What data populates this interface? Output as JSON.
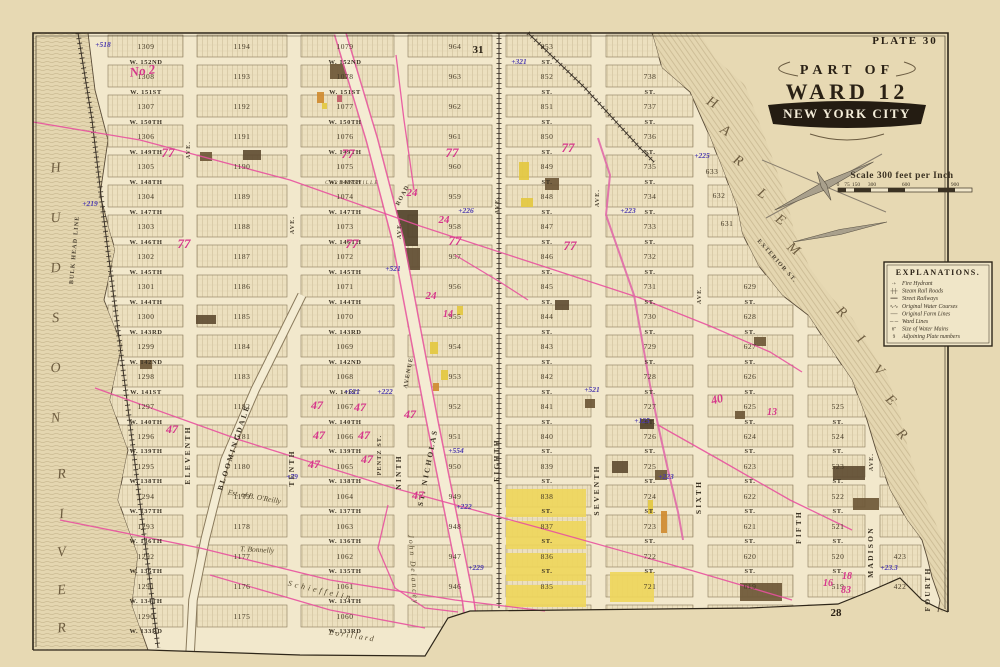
{
  "plate": {
    "label": "PLATE 30",
    "page_top": "31",
    "page_bottom": "28"
  },
  "title": {
    "line1": "PART OF",
    "line2": "WARD 12",
    "line3": "NEW YORK CITY"
  },
  "scale": {
    "caption": "Scale 300 feet per Inch",
    "ticks": [
      "0",
      "75",
      "150",
      "300",
      "600",
      "900"
    ]
  },
  "legend": {
    "title": "EXPLANATIONS.",
    "items": [
      {
        "sym": "·+",
        "label": "Fire Hydrant"
      },
      {
        "sym": "┼┼",
        "label": "Steam Rail Roads"
      },
      {
        "sym": "══",
        "label": "Street Railways"
      },
      {
        "sym": "∿∿",
        "label": "Original Water Courses"
      },
      {
        "sym": "──",
        "label": "Original Farm Lines"
      },
      {
        "sym": "─ ─",
        "label": "Ward Lines"
      },
      {
        "sym": "6″",
        "label": "Size of Water Mains"
      },
      {
        "sym": "9",
        "label": "Adjoining Plate numbers"
      }
    ]
  },
  "map": {
    "street_suffix": "ST.",
    "streets": [
      {
        "name": "W. 152ND",
        "y": 62
      },
      {
        "name": "W. 151ST",
        "y": 92
      },
      {
        "name": "W. 150TH",
        "y": 122
      },
      {
        "name": "W. 149TH",
        "y": 152
      },
      {
        "name": "W. 148TH",
        "y": 182
      },
      {
        "name": "W. 147TH",
        "y": 212
      },
      {
        "name": "W. 146TH",
        "y": 242
      },
      {
        "name": "W. 145TH",
        "y": 272
      },
      {
        "name": "W. 144TH",
        "y": 302
      },
      {
        "name": "W. 143RD",
        "y": 332
      },
      {
        "name": "W. 142ND",
        "y": 362
      },
      {
        "name": "W. 141ST",
        "y": 392
      },
      {
        "name": "W. 140TH",
        "y": 422
      },
      {
        "name": "W. 139TH",
        "y": 451
      },
      {
        "name": "W. 138TH",
        "y": 481
      },
      {
        "name": "W. 137TH",
        "y": 511
      },
      {
        "name": "W. 136TH",
        "y": 541
      },
      {
        "name": "W. 135TH",
        "y": 571
      },
      {
        "name": "W. 134TH",
        "y": 601
      },
      {
        "name": "W. 133RD",
        "y": 631
      }
    ],
    "avenues": [
      {
        "t": "ELEVENTH",
        "x": 190,
        "y": 455,
        "r": -90,
        "c": "ave"
      },
      {
        "t": "TENTH",
        "x": 294,
        "y": 468,
        "r": -90,
        "c": "ave"
      },
      {
        "t": "NINTH",
        "x": 401,
        "y": 472,
        "r": -90,
        "c": "ave"
      },
      {
        "t": "EIGHTH",
        "x": 499,
        "y": 460,
        "r": -90,
        "c": "ave"
      },
      {
        "t": "SEVENTH",
        "x": 599,
        "y": 490,
        "r": -90,
        "c": "ave"
      },
      {
        "t": "SIXTH",
        "x": 701,
        "y": 497,
        "r": -90,
        "c": "ave"
      },
      {
        "t": "FIFTH",
        "x": 801,
        "y": 527,
        "r": -90,
        "c": "ave"
      },
      {
        "t": "MADISON",
        "x": 873,
        "y": 552,
        "r": -90,
        "c": "ave"
      },
      {
        "t": "FOURTH",
        "x": 930,
        "y": 589,
        "r": -90,
        "c": "ave"
      },
      {
        "t": "AVE.",
        "x": 190,
        "y": 150,
        "r": -90,
        "c": "avs"
      },
      {
        "t": "AVE.",
        "x": 294,
        "y": 225,
        "r": -90,
        "c": "avs"
      },
      {
        "t": "AVE.",
        "x": 401,
        "y": 230,
        "r": -90,
        "c": "avs"
      },
      {
        "t": "AVE.",
        "x": 499,
        "y": 205,
        "r": -90,
        "c": "avs"
      },
      {
        "t": "AVE.",
        "x": 599,
        "y": 198,
        "r": -90,
        "c": "avs"
      },
      {
        "t": "AVE.",
        "x": 701,
        "y": 295,
        "r": -90,
        "c": "avs"
      },
      {
        "t": "AVE.",
        "x": 873,
        "y": 462,
        "r": -90,
        "c": "avs"
      },
      {
        "t": "ST. NICHOLAS",
        "x": 430,
        "y": 468,
        "r": -79,
        "c": "ave"
      },
      {
        "t": "AVENUE",
        "x": 410,
        "y": 373,
        "r": -79,
        "c": "avs"
      },
      {
        "t": "ROAD",
        "x": 404,
        "y": 196,
        "r": -62,
        "c": "avs"
      },
      {
        "t": "BLOOMINGDALE",
        "x": 236,
        "y": 448,
        "r": -72,
        "c": "ave"
      },
      {
        "t": "EXTERIOR ST.",
        "x": 776,
        "y": 262,
        "r": 48,
        "c": "avs"
      },
      {
        "t": "BULK HEAD LINE",
        "x": 76,
        "y": 250,
        "r": -85,
        "c": "avs"
      },
      {
        "t": "PENTZ ST.",
        "x": 381,
        "y": 455,
        "r": -90,
        "c": "avs"
      }
    ],
    "block_columns": [
      {
        "x": 146,
        "x0": 108,
        "x1": 183,
        "first": 1290
      },
      {
        "x": 242,
        "x0": 197,
        "x1": 287,
        "first": 1175
      },
      {
        "x": 345,
        "x0": 301,
        "x1": 394,
        "first": 1060
      },
      {
        "x": 455,
        "x0": 408,
        "x1": 492,
        "first": 945
      },
      {
        "x": 547,
        "x0": 506,
        "x1": 591,
        "first": 834
      },
      {
        "x": 650,
        "x0": 606,
        "x1": 693,
        "first": 720
      },
      {
        "x": 750,
        "x0": 708,
        "x1": 793,
        "first": 618
      },
      {
        "x": 838,
        "x0": 808,
        "x1": 865,
        "first": 518
      },
      {
        "x": 900,
        "x0": 880,
        "x1": 921,
        "first": 421
      }
    ],
    "extra_blocks": [
      {
        "t": "633",
        "x": 712,
        "y": 174
      },
      {
        "t": "632",
        "x": 719,
        "y": 198
      },
      {
        "t": "631",
        "x": 727,
        "y": 226
      }
    ],
    "rivers": {
      "hudson_name": "HUDSON RIVER",
      "harlem_name": "HARLEM RIVER",
      "hudson_letters": [
        {
          "t": "H",
          "x": 56,
          "y": 172
        },
        {
          "t": "U",
          "x": 56,
          "y": 222
        },
        {
          "t": "D",
          "x": 56,
          "y": 272
        },
        {
          "t": "S",
          "x": 56,
          "y": 322
        },
        {
          "t": "O",
          "x": 56,
          "y": 372
        },
        {
          "t": "N",
          "x": 56,
          "y": 422
        },
        {
          "t": "R",
          "x": 62,
          "y": 478
        },
        {
          "t": "I",
          "x": 62,
          "y": 518
        },
        {
          "t": "V",
          "x": 62,
          "y": 556
        },
        {
          "t": "E",
          "x": 62,
          "y": 594
        },
        {
          "t": "R",
          "x": 62,
          "y": 632
        }
      ],
      "harlem_letters": [
        {
          "t": "H",
          "x": 710,
          "y": 106,
          "r": 30
        },
        {
          "t": "A",
          "x": 723,
          "y": 134,
          "r": 32
        },
        {
          "t": "R",
          "x": 736,
          "y": 164,
          "r": 33
        },
        {
          "t": "L",
          "x": 760,
          "y": 197,
          "r": 35
        },
        {
          "t": "E",
          "x": 778,
          "y": 223,
          "r": 36
        },
        {
          "t": "M",
          "x": 791,
          "y": 252,
          "r": 38
        },
        {
          "t": "R",
          "x": 839,
          "y": 315,
          "r": 40
        },
        {
          "t": "I",
          "x": 858,
          "y": 342,
          "r": 42
        },
        {
          "t": "V",
          "x": 876,
          "y": 373,
          "r": 43
        },
        {
          "t": "E",
          "x": 888,
          "y": 403,
          "r": 44
        },
        {
          "t": "R",
          "x": 899,
          "y": 437,
          "r": 45
        }
      ]
    },
    "annotations": {
      "purple": [
        {
          "t": "+518",
          "x": 103,
          "y": 47
        },
        {
          "t": "+219",
          "x": 90,
          "y": 206
        },
        {
          "t": "+321",
          "x": 519,
          "y": 64
        },
        {
          "t": "+226",
          "x": 466,
          "y": 213
        },
        {
          "t": "+223",
          "x": 628,
          "y": 213
        },
        {
          "t": "+225",
          "x": 702,
          "y": 158
        },
        {
          "t": "+521",
          "x": 393,
          "y": 271
        },
        {
          "t": "+521",
          "x": 352,
          "y": 394
        },
        {
          "t": "+222",
          "x": 385,
          "y": 394
        },
        {
          "t": "+554",
          "x": 456,
          "y": 453
        },
        {
          "t": "+222",
          "x": 464,
          "y": 509
        },
        {
          "t": "+521",
          "x": 592,
          "y": 392
        },
        {
          "t": "+125",
          "x": 642,
          "y": 423
        },
        {
          "t": "+223",
          "x": 666,
          "y": 479
        },
        {
          "t": "+229",
          "x": 476,
          "y": 570
        },
        {
          "t": "+79",
          "x": 292,
          "y": 479
        },
        {
          "t": "+23.3",
          "x": 889,
          "y": 570
        }
      ],
      "magenta": [
        {
          "t": "No 2",
          "x": 143,
          "y": 75,
          "s": 13,
          "r": -8
        },
        {
          "t": "77",
          "x": 168,
          "y": 157,
          "s": 13
        },
        {
          "t": "77",
          "x": 184,
          "y": 248,
          "s": 13
        },
        {
          "t": "77",
          "x": 348,
          "y": 158,
          "s": 13
        },
        {
          "t": "77",
          "x": 352,
          "y": 248,
          "s": 13
        },
        {
          "t": "77",
          "x": 452,
          "y": 157,
          "s": 13
        },
        {
          "t": "77",
          "x": 455,
          "y": 245,
          "s": 13
        },
        {
          "t": "77",
          "x": 568,
          "y": 152,
          "s": 13
        },
        {
          "t": "77",
          "x": 570,
          "y": 250,
          "s": 13
        },
        {
          "t": "24",
          "x": 412,
          "y": 196,
          "s": 11
        },
        {
          "t": "24",
          "x": 444,
          "y": 223,
          "s": 11
        },
        {
          "t": "24",
          "x": 431,
          "y": 299,
          "s": 11
        },
        {
          "t": "14",
          "x": 448,
          "y": 317,
          "s": 10
        },
        {
          "t": "47",
          "x": 172,
          "y": 433,
          "s": 12
        },
        {
          "t": "47",
          "x": 317,
          "y": 409,
          "s": 12
        },
        {
          "t": "47",
          "x": 319,
          "y": 439,
          "s": 12
        },
        {
          "t": "47",
          "x": 314,
          "y": 468,
          "s": 12
        },
        {
          "t": "47",
          "x": 360,
          "y": 411,
          "s": 12
        },
        {
          "t": "47",
          "x": 364,
          "y": 439,
          "s": 12
        },
        {
          "t": "47",
          "x": 367,
          "y": 463,
          "s": 12
        },
        {
          "t": "47",
          "x": 410,
          "y": 418,
          "s": 12
        },
        {
          "t": "47",
          "x": 418,
          "y": 499,
          "s": 12
        },
        {
          "t": "40",
          "x": 718,
          "y": 403,
          "s": 12,
          "r": -15
        },
        {
          "t": "13",
          "x": 772,
          "y": 415,
          "s": 10
        },
        {
          "t": "16",
          "x": 828,
          "y": 586,
          "s": 10
        },
        {
          "t": "18",
          "x": 847,
          "y": 579,
          "s": 10
        },
        {
          "t": "83",
          "x": 846,
          "y": 593,
          "s": 10
        }
      ]
    },
    "names": [
      {
        "t": "CARMANSVILLE",
        "x": 352,
        "y": 184,
        "s": 5,
        "ls": 1.5
      },
      {
        "t": "Est. of B. O'Reilly",
        "x": 254,
        "y": 499,
        "r": 10,
        "s": 7.5
      },
      {
        "t": "T. Bonnelly",
        "x": 257,
        "y": 552,
        "r": 3,
        "s": 7.5
      },
      {
        "t": "Schieffelin",
        "x": 320,
        "y": 593,
        "r": 13,
        "s": 8,
        "ls": 3
      },
      {
        "t": "John Delancey",
        "x": 411,
        "y": 570,
        "r": 86,
        "s": 7.5,
        "ls": 2
      },
      {
        "t": "Lorillard",
        "x": 352,
        "y": 638,
        "r": 9,
        "s": 8,
        "ls": 2
      }
    ],
    "buildings": [
      {
        "x": 330,
        "y": 64,
        "w": 26,
        "h": 15,
        "c": "#6a5434"
      },
      {
        "x": 317,
        "y": 92,
        "w": 7,
        "h": 11,
        "c": "#cf8a2e"
      },
      {
        "x": 337,
        "y": 95,
        "w": 5,
        "h": 7,
        "c": "#c25b66"
      },
      {
        "x": 322,
        "y": 103,
        "w": 5,
        "h": 6,
        "c": "#e3c83e"
      },
      {
        "x": 200,
        "y": 152,
        "w": 12,
        "h": 9,
        "c": "#6a5434"
      },
      {
        "x": 243,
        "y": 150,
        "w": 18,
        "h": 10,
        "c": "#5d4a30"
      },
      {
        "x": 519,
        "y": 162,
        "w": 10,
        "h": 18,
        "c": "#e3c83e"
      },
      {
        "x": 545,
        "y": 178,
        "w": 14,
        "h": 12,
        "c": "#6a5434"
      },
      {
        "x": 521,
        "y": 198,
        "w": 12,
        "h": 9,
        "c": "#e3c83e"
      },
      {
        "x": 88,
        "y": 318,
        "w": 16,
        "h": 7,
        "c": "#e3c83e"
      },
      {
        "x": 87,
        "y": 327,
        "w": 14,
        "h": 6,
        "c": "#cf8a2e"
      },
      {
        "x": 140,
        "y": 360,
        "w": 12,
        "h": 9,
        "c": "#6a5434"
      },
      {
        "x": 196,
        "y": 315,
        "w": 20,
        "h": 9,
        "c": "#5d4a30"
      },
      {
        "x": 396,
        "y": 210,
        "w": 22,
        "h": 36,
        "c": "#4f3f28"
      },
      {
        "x": 404,
        "y": 248,
        "w": 16,
        "h": 22,
        "c": "#5d4a30"
      },
      {
        "x": 430,
        "y": 342,
        "w": 8,
        "h": 12,
        "c": "#e3c83e"
      },
      {
        "x": 441,
        "y": 370,
        "w": 7,
        "h": 10,
        "c": "#e3c83e"
      },
      {
        "x": 433,
        "y": 383,
        "w": 6,
        "h": 8,
        "c": "#cf8a2e"
      },
      {
        "x": 457,
        "y": 306,
        "w": 6,
        "h": 9,
        "c": "#e3c83e"
      },
      {
        "x": 585,
        "y": 399,
        "w": 10,
        "h": 9,
        "c": "#6a5434"
      },
      {
        "x": 612,
        "y": 461,
        "w": 16,
        "h": 12,
        "c": "#5d4a30"
      },
      {
        "x": 640,
        "y": 419,
        "w": 14,
        "h": 10,
        "c": "#4f3f28"
      },
      {
        "x": 655,
        "y": 470,
        "w": 12,
        "h": 10,
        "c": "#6a5434"
      },
      {
        "x": 754,
        "y": 337,
        "w": 12,
        "h": 9,
        "c": "#6a5434"
      },
      {
        "x": 735,
        "y": 411,
        "w": 10,
        "h": 8,
        "c": "#6a5434"
      },
      {
        "x": 555,
        "y": 300,
        "w": 14,
        "h": 10,
        "c": "#5d4a30"
      },
      {
        "x": 506,
        "y": 489,
        "w": 80,
        "h": 28,
        "c": "#eed65a"
      },
      {
        "x": 506,
        "y": 521,
        "w": 80,
        "h": 28,
        "c": "#eed65a"
      },
      {
        "x": 506,
        "y": 553,
        "w": 80,
        "h": 28,
        "c": "#eed65a"
      },
      {
        "x": 506,
        "y": 585,
        "w": 80,
        "h": 22,
        "c": "#eed65a"
      },
      {
        "x": 610,
        "y": 572,
        "w": 44,
        "h": 30,
        "c": "#eed65a"
      },
      {
        "x": 661,
        "y": 511,
        "w": 6,
        "h": 22,
        "c": "#cf8a2e"
      },
      {
        "x": 648,
        "y": 500,
        "w": 5,
        "h": 14,
        "c": "#e3c83e"
      },
      {
        "x": 740,
        "y": 583,
        "w": 42,
        "h": 18,
        "c": "#6a5434"
      },
      {
        "x": 833,
        "y": 466,
        "w": 32,
        "h": 14,
        "c": "#5d4a30"
      },
      {
        "x": 853,
        "y": 498,
        "w": 26,
        "h": 12,
        "c": "#6a5434"
      },
      {
        "x": 95,
        "y": 565,
        "w": 10,
        "h": 8,
        "c": "#6a5434"
      }
    ],
    "farm_lines": [
      {
        "pts": "33,122 140,140 290,180 420,226 530,262 640,298 710,326 770,352 802,372"
      },
      {
        "pts": "95,388 240,440 390,487 540,528 690,570 792,600"
      },
      {
        "pts": "60,520 200,548 330,580 455,600 545,611"
      },
      {
        "pts": "210,575 330,610 425,628"
      },
      {
        "pts": "598,138 610,175 606,215 620,255 634,295 642,340 650,385 658,425 668,470 678,512 683,540",
        "w": 2
      },
      {
        "pts": "658,425 720,460 790,500 852,530"
      },
      {
        "pts": "388,505 378,548 395,588 425,608 458,612"
      },
      {
        "pts": "396,55 404,120 414,190"
      },
      {
        "pts": "455,255 500,282 528,300"
      }
    ],
    "colors": {
      "farm_line": "#e8519e",
      "stream": "#e06aa8",
      "purple": "#4b3aae",
      "magenta": "#d6368b"
    }
  }
}
